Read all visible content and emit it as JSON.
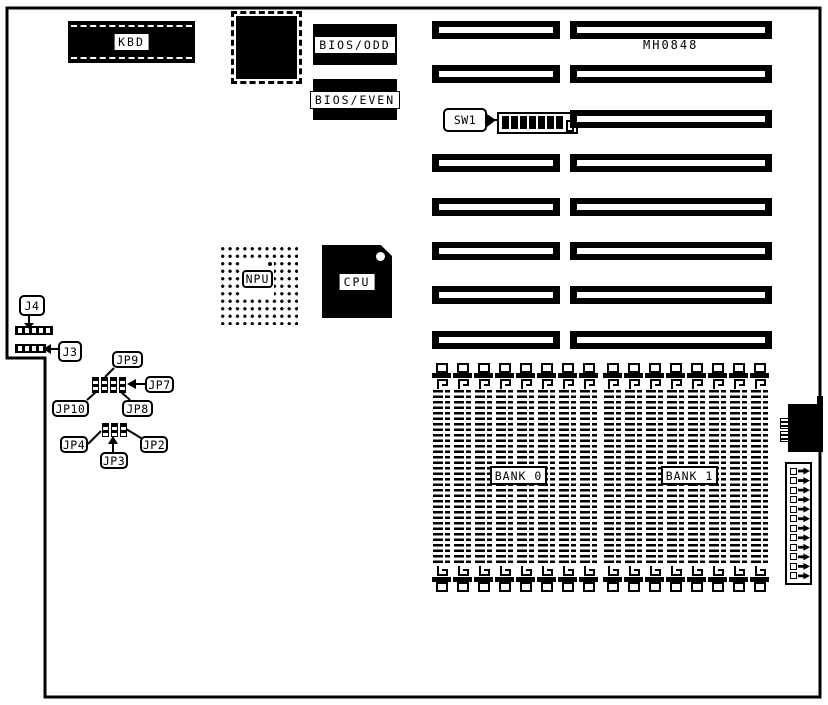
{
  "board": {
    "model_number": "MH0848"
  },
  "components": {
    "kbd": {
      "label": "KBD"
    },
    "bios_odd": {
      "label": "BIOS/ODD"
    },
    "bios_even": {
      "label": "BIOS/EVEN"
    },
    "npu": {
      "label": "NPU"
    },
    "cpu": {
      "label": "CPU"
    },
    "sw1": {
      "label": "SW1",
      "positions": 8,
      "on_count": 7
    },
    "j4": {
      "label": "J4",
      "pins": 5
    },
    "j3": {
      "label": "J3",
      "pins": 4
    },
    "power": {
      "pins": 12
    }
  },
  "jumper_blocks": {
    "a": {
      "bars": 4
    },
    "b": {
      "bars": 3
    }
  },
  "jumpers": {
    "jp9": "JP9",
    "jp7": "JP7",
    "jp10": "JP10",
    "jp8": "JP8",
    "jp4": "JP4",
    "jp2": "JP2",
    "jp3": "JP3"
  },
  "expansion_slots": {
    "left_count": 7,
    "right_count": 8
  },
  "memory_banks": [
    {
      "id": "bank0",
      "label": "BANK 0",
      "simm_count": 8
    },
    {
      "id": "bank1",
      "label": "BANK 1",
      "simm_count": 8
    }
  ]
}
